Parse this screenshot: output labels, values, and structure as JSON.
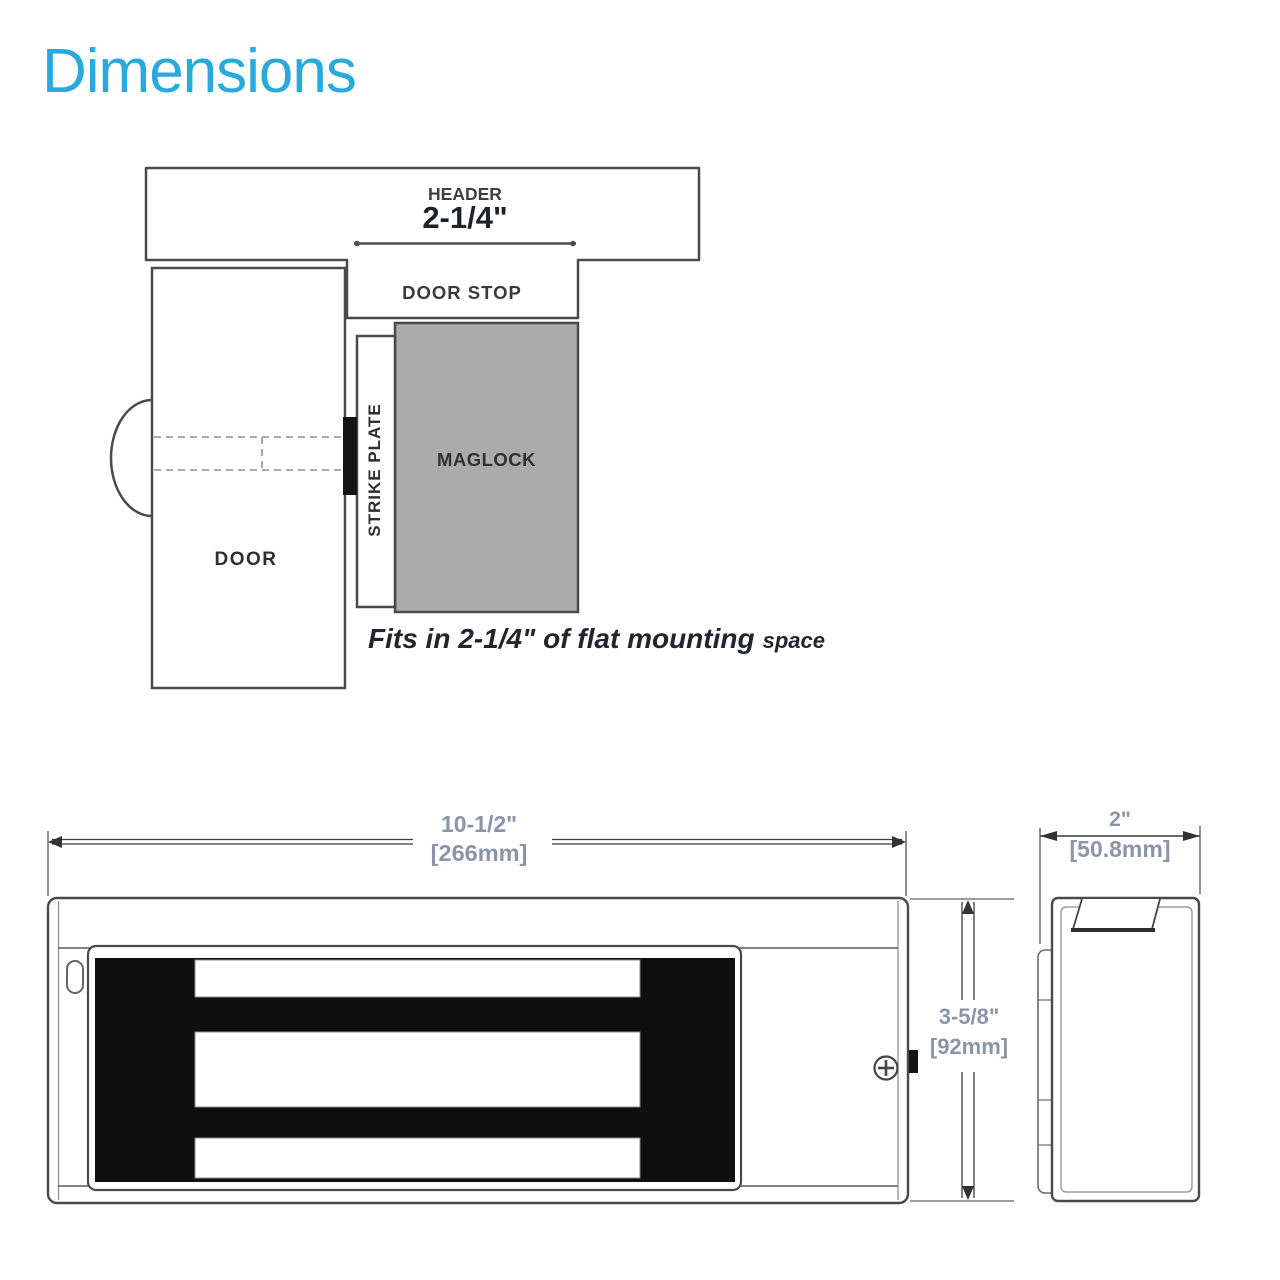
{
  "title": "Dimensions",
  "colors": {
    "accent": "#29a9dc",
    "line": "#4a4a4a",
    "maglock_fill": "#ababab",
    "dim_text": "#8a96a8",
    "dark_fill": "#111111"
  },
  "top_diagram": {
    "labels": {
      "header": "HEADER",
      "door_stop": "DOOR STOP",
      "strike_plate": "STRIKE PLATE",
      "maglock": "MAGLOCK",
      "door": "DOOR"
    },
    "dimension": "2-1/4\"",
    "caption": {
      "main": "Fits in 2-1/4\" of flat mounting",
      "suffix": "space"
    }
  },
  "front_view": {
    "width_dim": {
      "inches": "10-1/2\"",
      "mm": "[266mm]"
    },
    "height_dim": {
      "inches": "3-5/8\"",
      "mm": "[92mm]"
    }
  },
  "side_view": {
    "width_dim": {
      "inches": "2\"",
      "mm": "[50.8mm]"
    }
  }
}
